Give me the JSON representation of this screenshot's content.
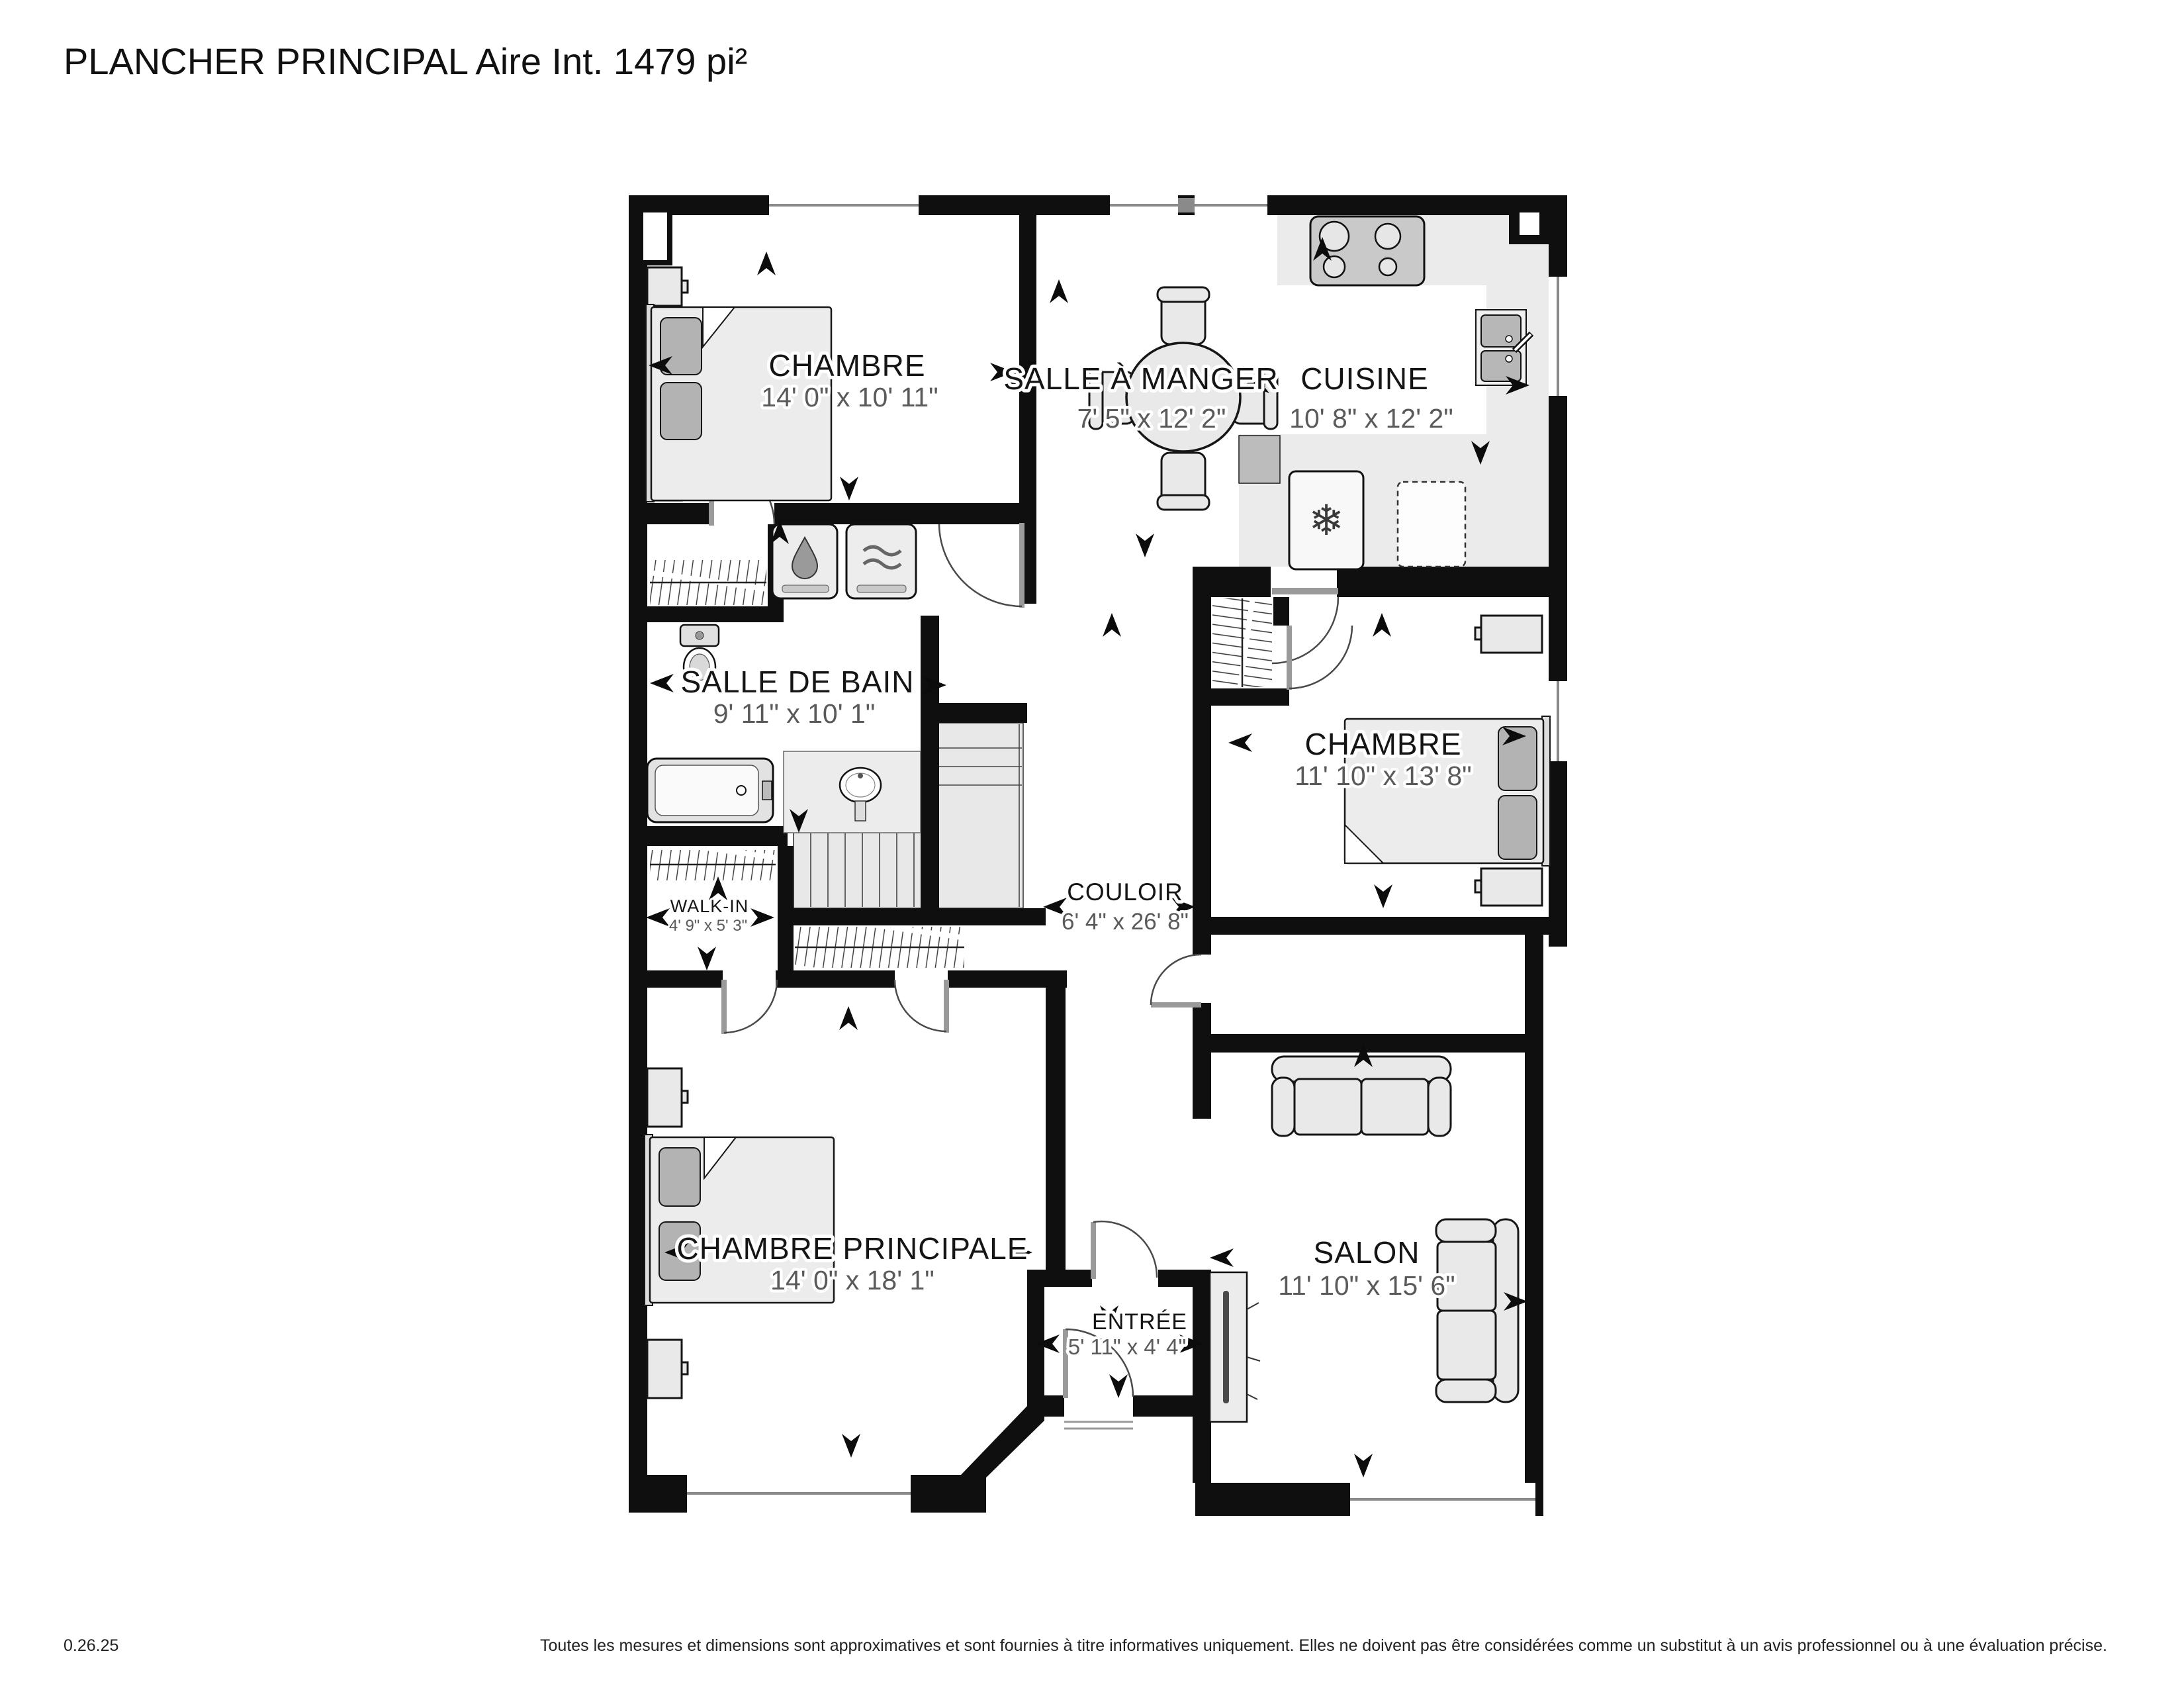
{
  "title": "PLANCHER PRINCIPAL Aire Int. 1479 pi²",
  "rooms": {
    "bedroom_tl": {
      "name": "CHAMBRE",
      "dims": "14' 0\" x 10' 11\""
    },
    "dining": {
      "name": "SALLE À MANGER",
      "dims": "7' 5\" x 12' 2\""
    },
    "kitchen": {
      "name": "CUISINE",
      "dims": "10' 8\" x 12' 2\""
    },
    "bathroom": {
      "name": "SALLE DE BAIN",
      "dims": "9' 11\" x 10' 1\""
    },
    "bedroom_right": {
      "name": "CHAMBRE",
      "dims": "11' 10\" x 13' 8\""
    },
    "walk_in": {
      "name": "WALK-IN",
      "dims": "4' 9\" x 5' 3\""
    },
    "hallway": {
      "name": "COULOIR",
      "dims": "6' 4\" x 26' 8\""
    },
    "master": {
      "name": "CHAMBRE PRINCIPALE",
      "dims": "14' 0\" x 18' 1\""
    },
    "entry": {
      "name": "ENTRÉE",
      "dims": "5' 11\" x 4' 4\""
    },
    "living": {
      "name": "SALON",
      "dims": "11' 10\" x 15' 6\""
    }
  },
  "icons": {
    "fridge_snowflake": "❄"
  },
  "footer": {
    "version": "0.26.25",
    "disclaimer": "Toutes les mesures et dimensions sont approximatives et sont fournies à titre informatives uniquement. Elles ne doivent pas être considérées comme un substitut à un avis professionnel ou à une évaluation précise."
  },
  "colors": {
    "wall": "#0f0f0f",
    "kitchen_floor": "#ebebeb",
    "dims_text": "#5a5a5a",
    "furniture": "#e9e9e9"
  }
}
